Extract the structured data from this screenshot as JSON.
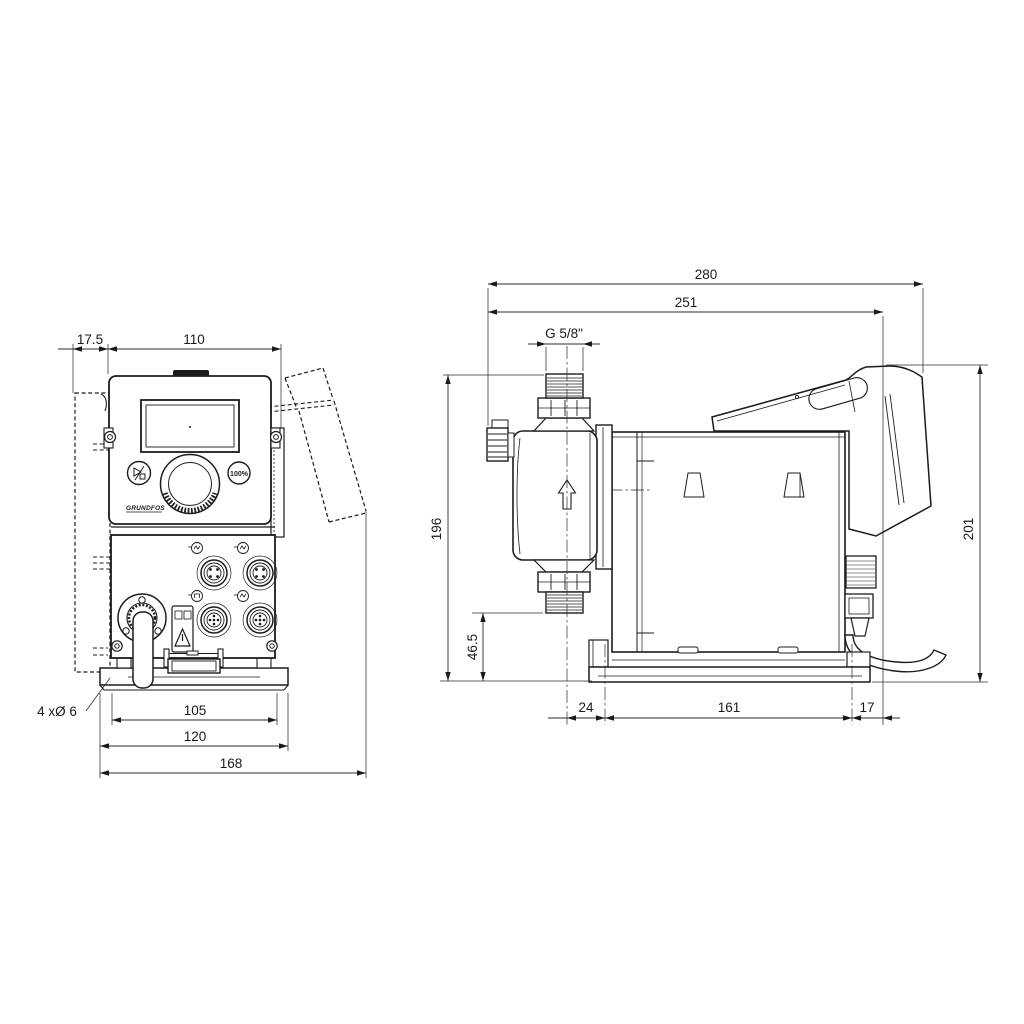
{
  "drawing": {
    "front_view": {
      "dims": {
        "wall_offset": "17.5",
        "panel_width": "110",
        "slot_spacing": "105",
        "plate_width": "120",
        "overall_width": "168"
      },
      "hole_note": "4 xØ 6",
      "panel": {
        "boost_button": "100%",
        "logo": "GRUNDFOS"
      }
    },
    "side_view": {
      "dims": {
        "overall_depth": "280",
        "depth_to_cable": "251",
        "connection_thread": "G 5/8\"",
        "valve_top_height": "196",
        "suction_valve_height": "46.5",
        "front_hole_offset": "24",
        "hole_spacing": "161",
        "rear_hole_offset": "17",
        "overall_height": "201"
      }
    }
  }
}
